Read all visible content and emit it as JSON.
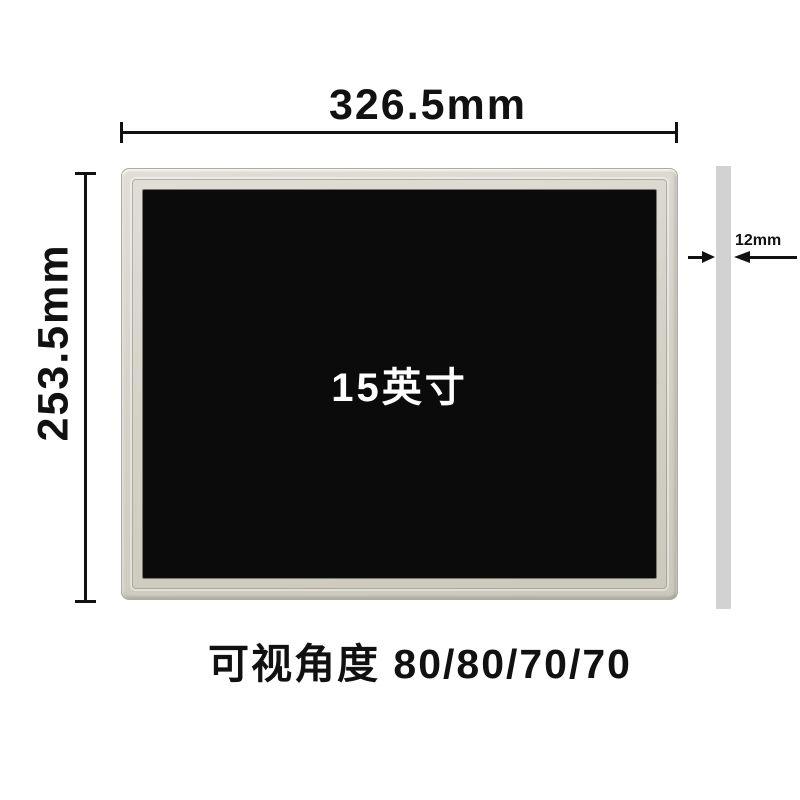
{
  "colors": {
    "background": "#ffffff",
    "dimension_line": "#111111",
    "text": "#111111",
    "bezel": "#d5d2c8",
    "screen": "#0b0b0b",
    "screen_label": "#ffffff",
    "side_profile": "#d2d2d2"
  },
  "dimensions": {
    "width": {
      "label": "326.5mm"
    },
    "height": {
      "label": "253.5mm"
    },
    "thickness": {
      "label": "12mm"
    }
  },
  "panel": {
    "screen_size_label": "15英寸"
  },
  "caption": {
    "text": "可视角度 80/80/70/70"
  }
}
